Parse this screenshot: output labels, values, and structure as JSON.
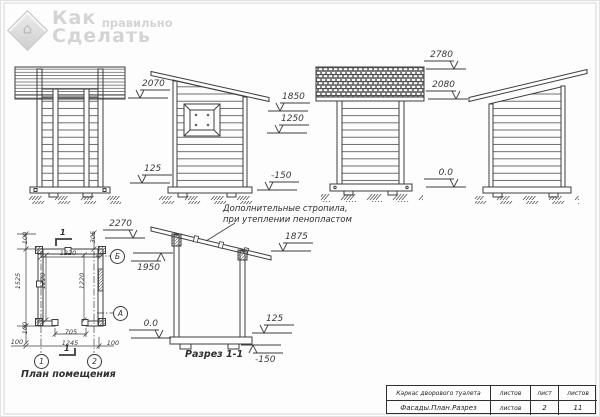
{
  "logo": {
    "word1": "Как",
    "word2": "правильно",
    "word3": "Сделать",
    "house_icon": "house-icon"
  },
  "annotation": {
    "line1": "Дополнительные стропила,",
    "line2": "при утеплении пенопластом"
  },
  "titles": {
    "section": "Разрез 1-1",
    "plan": "План помещения"
  },
  "level_marks": [
    {
      "label": "2070",
      "x": 139,
      "y": 97,
      "dir": "down",
      "side": "right"
    },
    {
      "label": "125",
      "x": 141,
      "y": 182,
      "dir": "down",
      "side": "right"
    },
    {
      "label": "1850",
      "x": 279,
      "y": 110,
      "dir": "down",
      "side": "right"
    },
    {
      "label": "1250",
      "x": 278,
      "y": 132,
      "dir": "down",
      "side": "right"
    },
    {
      "label": "-150",
      "x": 268,
      "y": 189,
      "dir": "down",
      "side": "right"
    },
    {
      "label": "2780",
      "x": 453,
      "y": 68,
      "dir": "down",
      "side": "left"
    },
    {
      "label": "2080",
      "x": 455,
      "y": 98,
      "dir": "down",
      "side": "left"
    },
    {
      "label": "0.0",
      "x": 453,
      "y": 186,
      "dir": "down",
      "side": "left"
    },
    {
      "label": "2270",
      "x": 132,
      "y": 237,
      "dir": "down",
      "side": "left"
    },
    {
      "label": "1950",
      "x": 160,
      "y": 252,
      "dir": "up",
      "side": "left"
    },
    {
      "label": "1875",
      "x": 282,
      "y": 250,
      "dir": "down",
      "side": "right"
    },
    {
      "label": "0.0",
      "x": 158,
      "y": 337,
      "dir": "down",
      "side": "left"
    },
    {
      "label": "125",
      "x": 263,
      "y": 332,
      "dir": "down",
      "side": "right"
    },
    {
      "label": "-150",
      "x": 252,
      "y": 344,
      "dir": "up",
      "side": "right"
    }
  ],
  "plan_dims": [
    {
      "label": "1220",
      "x": 52,
      "y": 248,
      "rot": 0
    },
    {
      "label": "100",
      "x": 20,
      "y": 250,
      "rot": -90
    },
    {
      "label": "305",
      "x": 88,
      "y": 249,
      "rot": -90
    },
    {
      "label": "1525",
      "x": 13,
      "y": 293,
      "rot": -90
    },
    {
      "label": "1220",
      "x": 38,
      "y": 293,
      "rot": -90
    },
    {
      "label": "1220",
      "x": 77,
      "y": 293,
      "rot": -90
    },
    {
      "label": "100",
      "x": 20,
      "y": 340,
      "rot": -90
    },
    {
      "label": "705",
      "x": 55,
      "y": 327,
      "rot": 0
    },
    {
      "label": "1245",
      "x": 54,
      "y": 338,
      "rot": 0
    },
    {
      "label": "100",
      "x": 1,
      "y": 337,
      "rot": 0
    },
    {
      "label": "100",
      "x": 97,
      "y": 338,
      "rot": 0
    }
  ],
  "axes": [
    {
      "label": "Б",
      "cx": 116,
      "cy": 255
    },
    {
      "label": "А",
      "cx": 119,
      "cy": 312
    },
    {
      "label": "1",
      "cx": 40,
      "cy": 360
    },
    {
      "label": "2",
      "cx": 93,
      "cy": 360
    }
  ],
  "cut_marks": [
    {
      "label": "1",
      "x": 59,
      "y": 227
    },
    {
      "label": "1",
      "x": 63,
      "y": 343
    }
  ],
  "title_block": {
    "rows": [
      [
        "Каркас дворового туалета",
        "листов",
        "лист",
        "листов"
      ],
      [
        "Фасады.План.Разрез",
        "листов",
        "2",
        "11"
      ]
    ]
  },
  "colors": {
    "line": "#3d3d3d",
    "logo_gray": "#d4d4d4",
    "frame": "#cfcfcf"
  }
}
